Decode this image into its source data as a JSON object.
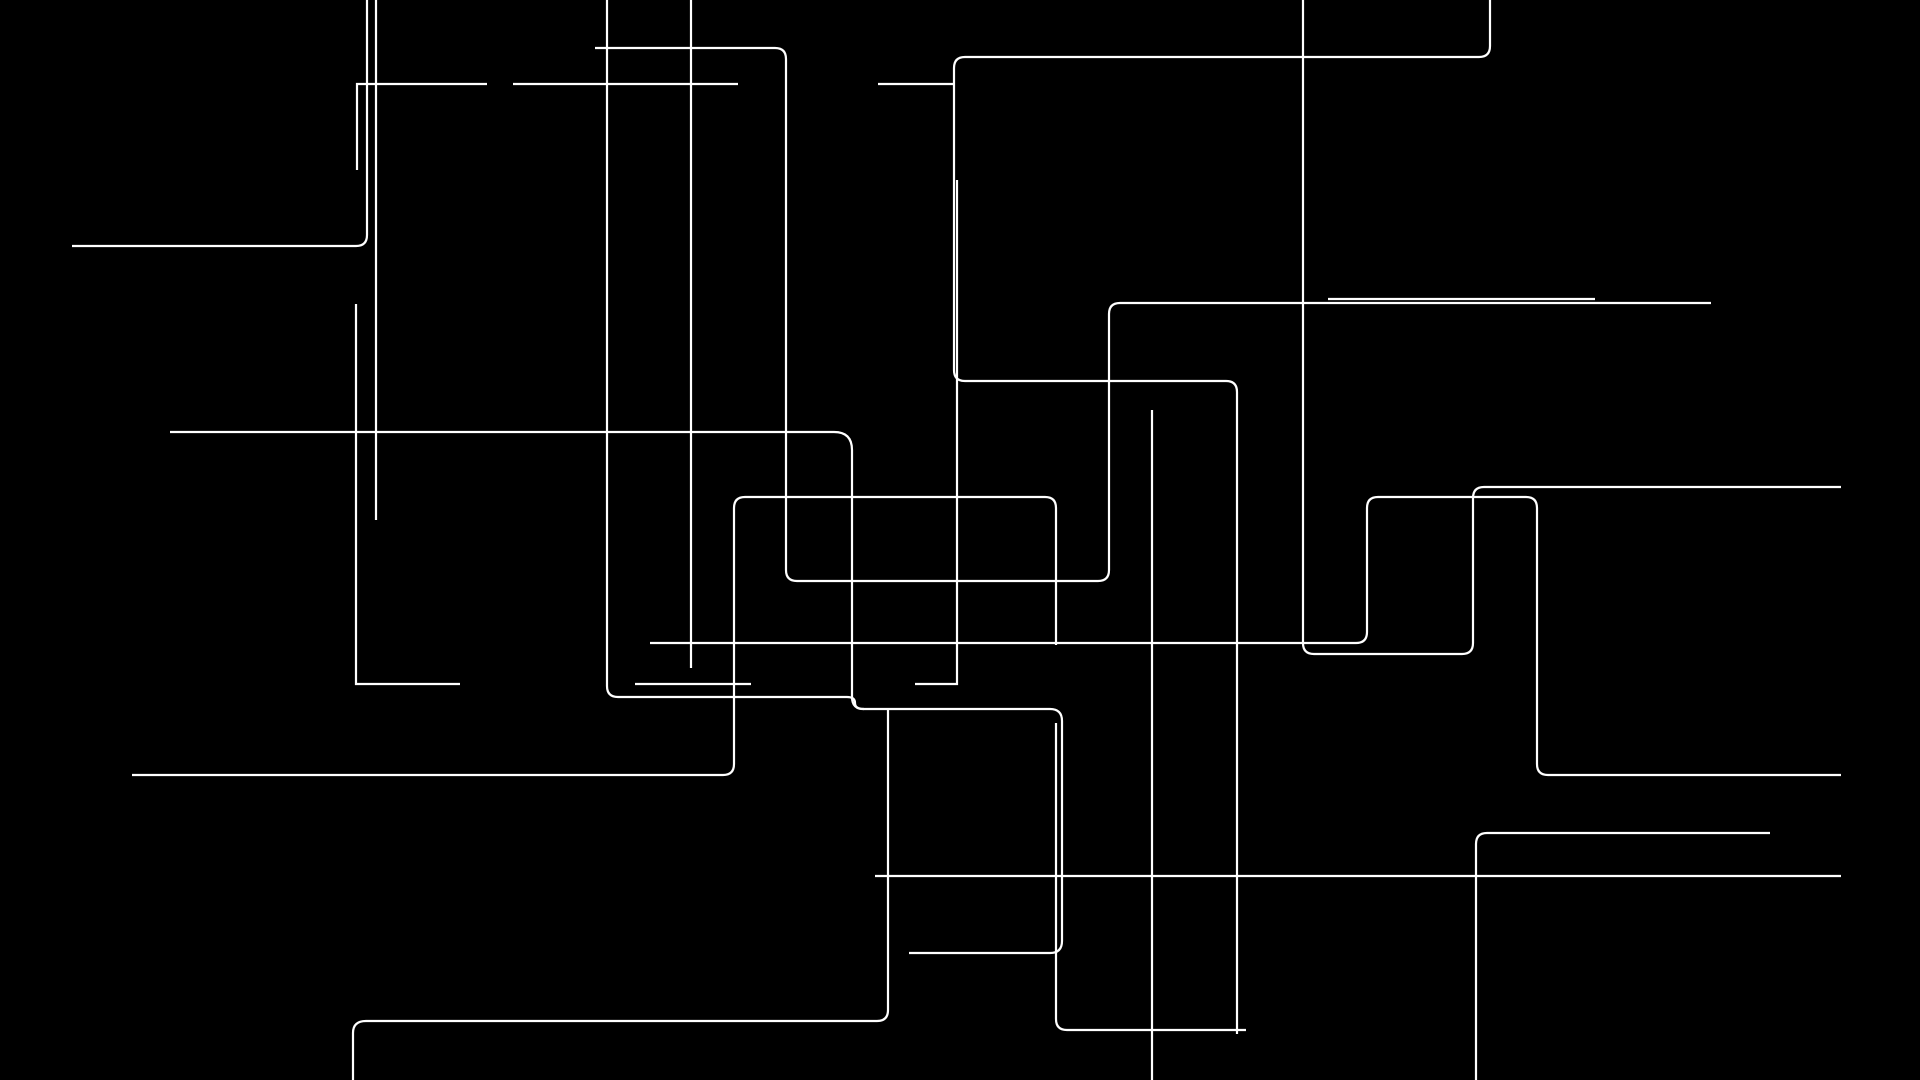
{
  "canvas": {
    "width": 1920,
    "height": 1080,
    "background_color": "#000000",
    "line_color": "#ffffff",
    "line_width": 2.2,
    "corner_radius": 11,
    "description": "abstract-white-orthogonal-line-art-on-black"
  },
  "art": {
    "paths": [
      {
        "id": "left-hook-to-top",
        "d": "M 72 246 L 356 246 Q 367 246 367 235 L 367 0"
      },
      {
        "id": "left-pair-long-vertical",
        "d": "M 376 0 L 376 520"
      },
      {
        "id": "left-short-L-h84",
        "d": "M 487 84 L 357 84 L 357 170"
      },
      {
        "id": "h84-middle-segment",
        "d": "M 513 84 L 738 84"
      },
      {
        "id": "h84-right-segment",
        "d": "M 878 84 L 953 84"
      },
      {
        "id": "left-mid-vertical-L",
        "d": "M 356 304 L 356 684 L 460 684"
      },
      {
        "id": "top-snake-big",
        "d": "M 595 48 L 775 48 Q 786 48 786 59 L 786 570 Q 786 581 797 581 L 1098 581 Q 1109 581 1109 570 L 1109 314 Q 1109 303 1120 303 L 1711 303"
      },
      {
        "id": "top-right-double-line",
        "d": "M 1328 299 L 1595 299"
      },
      {
        "id": "center-long-snake",
        "d": "M 607 0 L 607 686 Q 607 697 618 697 L 847 697 Q 855 697 855 703 Q 855 709 863 709 L 1050 709 Q 1062 709 1062 721 L 1062 941 Q 1062 953 1050 953 L 909 953"
      },
      {
        "id": "mid-horizontal-drop",
        "d": "M 170 432 L 834 432 Q 852 432 852 450 L 852 697 Q 852 709 864 709"
      },
      {
        "id": "center-drop-to-bottom-left",
        "d": "M 888 709 L 888 1010 Q 888 1021 877 1021 L 366 1021 Q 353 1021 353 1033 L 353 1080"
      },
      {
        "id": "center-vertical-691",
        "d": "M 691 0 L 691 668"
      },
      {
        "id": "right-grand-snake",
        "d": "M 1490 0 L 1490 46 Q 1490 57 1479 57 L 965 57 Q 954 57 954 68 L 954 370 Q 954 381 965 381 L 1226 381 Q 1237 381 1237 392 L 1237 1034"
      },
      {
        "id": "center-right-L-957",
        "d": "M 957 180 L 957 684 L 915 684"
      },
      {
        "id": "small-h684-segment",
        "d": "M 635 684 L 751 684"
      },
      {
        "id": "lower-left-up-over-snake",
        "d": "M 132 775 L 723 775 Q 734 775 734 764 L 734 508 Q 734 497 745 497 L 1045 497 Q 1056 497 1056 508 L 1056 645"
      },
      {
        "id": "v1056-lower-to-h1030",
        "d": "M 1056 723 L 1056 1019 Q 1056 1030 1067 1030 L 1246 1030"
      },
      {
        "id": "long-h643-stair-right",
        "d": "M 650 643 L 1356 643 Q 1367 643 1367 632 L 1367 508 Q 1367 497 1378 497 L 1526 497 Q 1537 497 1537 508 L 1537 764 Q 1537 775 1548 775 L 1841 775"
      },
      {
        "id": "v1303-u-turn-right",
        "d": "M 1303 0 L 1303 643 Q 1303 654 1314 654 L 1462 654 Q 1473 654 1473 643 L 1473 498 Q 1473 487 1484 487 L 1841 487"
      },
      {
        "id": "bottom-right-hook",
        "d": "M 1770 833 L 1487 833 Q 1476 833 1476 844 L 1476 1080"
      },
      {
        "id": "vertical-1152",
        "d": "M 1152 410 L 1152 1080"
      },
      {
        "id": "bottom-long-horizontal",
        "d": "M 875 876 L 1841 876"
      }
    ]
  }
}
